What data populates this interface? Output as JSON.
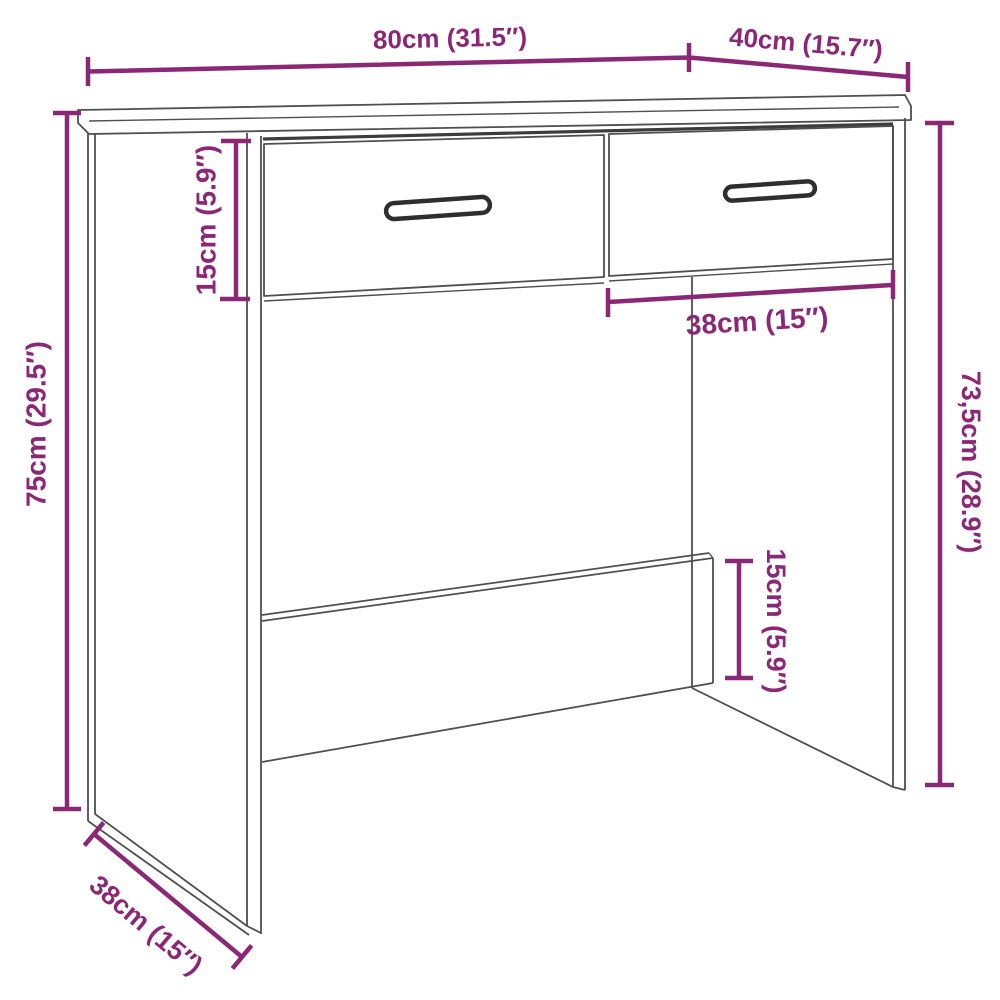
{
  "figure": {
    "type": "furniture-dimension-diagram",
    "subject": "Desk with two drawers, perspective line drawing with measurements",
    "background": "#ffffff",
    "line_color": "#4f4f4f",
    "dimension_color": "#8B2876"
  },
  "dimensions": {
    "top_width": {
      "label": "80cm (31.5″)",
      "value_cm": 80,
      "value_in": 31.5,
      "measures": "tabletop width"
    },
    "top_depth": {
      "label": "40cm (15.7″)",
      "value_cm": 40,
      "value_in": 15.7,
      "measures": "tabletop depth"
    },
    "drawer_height": {
      "label": "15cm (5.9″)",
      "value_cm": 15,
      "value_in": 5.9,
      "measures": "drawer front height"
    },
    "total_height": {
      "label": "75cm (29.5″)",
      "value_cm": 75,
      "value_in": 29.5,
      "measures": "overall height"
    },
    "inner_width": {
      "label": "38cm (15″)",
      "value_cm": 38,
      "value_in": 15,
      "measures": "inner opening width"
    },
    "inner_height": {
      "label": "73,5cm (28.9″)",
      "value_cm": 73.5,
      "value_in": 28.9,
      "measures": "side panel height"
    },
    "panel_height": {
      "label": "15cm (5.9″)",
      "value_cm": 15,
      "value_in": 5.9,
      "measures": "back panel height"
    },
    "side_depth": {
      "label": "38cm (15″)",
      "value_cm": 38,
      "value_in": 15,
      "measures": "side panel depth"
    }
  }
}
